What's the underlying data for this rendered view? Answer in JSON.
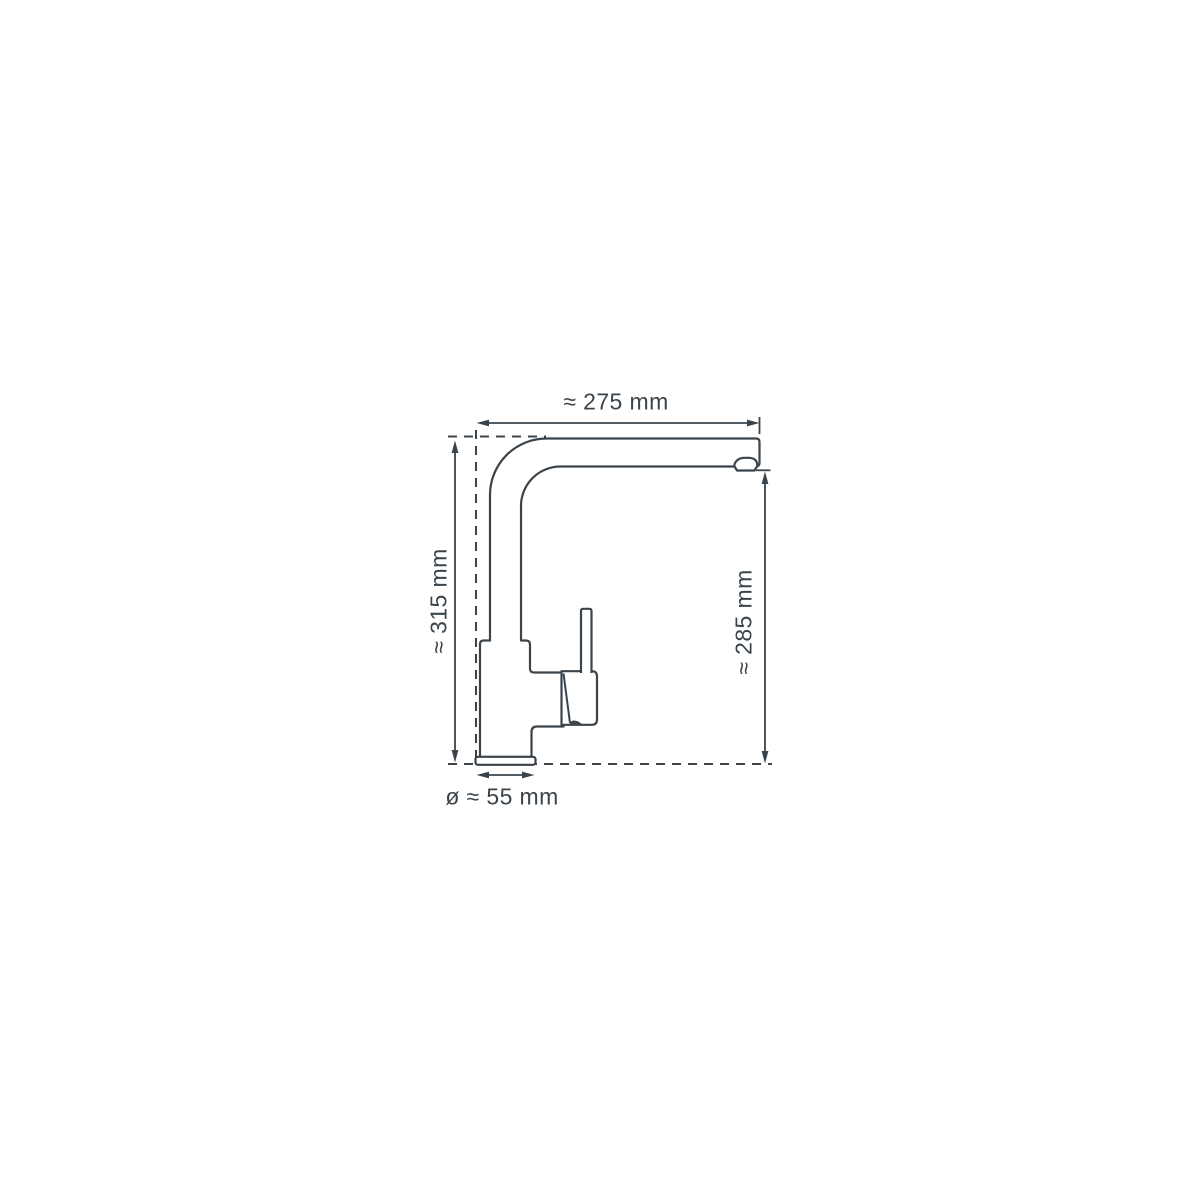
{
  "diagram": {
    "type": "technical-dimension-drawing",
    "subject": "kitchen-faucet-side-view",
    "background_color": "#ffffff",
    "line_color": "#3b444b",
    "dimensions": [
      {
        "id": "spout-reach",
        "label": "≈ 275 mm",
        "orientation": "horizontal",
        "position": "top"
      },
      {
        "id": "total-height",
        "label": "≈ 315 mm",
        "orientation": "vertical",
        "position": "left"
      },
      {
        "id": "spout-outlet-height",
        "label": "≈ 285 mm",
        "orientation": "vertical",
        "position": "right"
      },
      {
        "id": "base-diameter",
        "label": "ø ≈ 55 mm",
        "orientation": "horizontal",
        "position": "bottom"
      }
    ]
  }
}
